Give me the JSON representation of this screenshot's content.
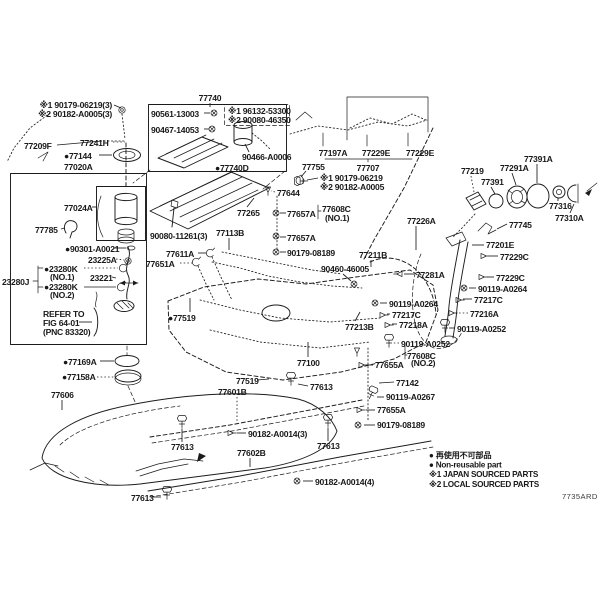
{
  "diagram": {
    "figure_code": "7735ARD",
    "legend": [
      {
        "prefix": "●",
        "text": "再使用不可部品"
      },
      {
        "prefix": "●",
        "text": "Non-reusable part"
      },
      {
        "prefix": "※1",
        "text": "JAPAN SOURCED PARTS"
      },
      {
        "prefix": "※2",
        "text": "LOCAL SOURCED PARTS"
      }
    ],
    "labels": [
      {
        "t": "※1 90179-06219(3)",
        "x": 112,
        "y": 108,
        "a": "e",
        "ln": [
          114,
          105,
          121,
          108
        ]
      },
      {
        "t": "※2 90182-A0005(3)",
        "x": 112,
        "y": 117,
        "a": "e"
      },
      {
        "t": "77209F",
        "x": 24,
        "y": 149,
        "ln": [
          57,
          145,
          102,
          141
        ]
      },
      {
        "t": "77241H",
        "x": 80,
        "y": 146,
        "ln": [
          113,
          142,
          125,
          142
        ],
        "ld": 1
      },
      {
        "t": "77144",
        "x": 64,
        "y": 159,
        "b": 1,
        "ln": [
          99,
          155,
          112,
          155
        ]
      },
      {
        "t": "77020A",
        "x": 64,
        "y": 170
      },
      {
        "t": "77740",
        "x": 210,
        "y": 101,
        "a": "m",
        "ln": [
          210,
          103,
          210,
          107
        ]
      },
      {
        "t": "90561-13003",
        "x": 151,
        "y": 117,
        "ln": [
          204,
          113,
          210,
          113
        ]
      },
      {
        "t": "90467-14053",
        "x": 151,
        "y": 133,
        "ln": [
          204,
          129,
          209,
          129
        ]
      },
      {
        "t": "※1 96132-53300",
        "x": 228,
        "y": 114
      },
      {
        "t": "※2 90080-46350",
        "x": 228,
        "y": 123
      },
      {
        "t": "90466-A0006",
        "x": 242,
        "y": 160,
        "ln": [
          249,
          152,
          245,
          144
        ]
      },
      {
        "t": "77740D",
        "x": 215,
        "y": 171,
        "b": 1
      },
      {
        "t": "77197A",
        "x": 333,
        "y": 156,
        "a": "m"
      },
      {
        "t": "77229E",
        "x": 376,
        "y": 156,
        "a": "m"
      },
      {
        "t": "77229E",
        "x": 420,
        "y": 156,
        "a": "m"
      },
      {
        "t": "77707",
        "x": 368,
        "y": 171,
        "a": "m"
      },
      {
        "t": "77755",
        "x": 302,
        "y": 170,
        "ln": [
          306,
          171,
          301,
          177
        ]
      },
      {
        "t": "※1 90179-06219",
        "x": 320,
        "y": 181,
        "ln": [
          318,
          178,
          307,
          180
        ]
      },
      {
        "t": "※2 90182-A0005",
        "x": 320,
        "y": 190
      },
      {
        "t": "77644",
        "x": 277,
        "y": 196,
        "ln": [
          275,
          192,
          271,
          191
        ],
        "ld": 1
      },
      {
        "t": "77657A",
        "x": 287,
        "y": 217,
        "ln": [
          286,
          213,
          280,
          213
        ]
      },
      {
        "t": "77608C",
        "x": 322,
        "y": 212
      },
      {
        "t": "(NO.1)",
        "x": 325,
        "y": 221
      },
      {
        "t": "77657A",
        "x": 287,
        "y": 241,
        "ln": [
          286,
          237,
          280,
          237
        ]
      },
      {
        "t": "90179-08189",
        "x": 287,
        "y": 256,
        "ln": [
          286,
          252,
          280,
          252
        ]
      },
      {
        "t": "90080-11261(3)",
        "x": 150,
        "y": 239
      },
      {
        "t": "77113B",
        "x": 216,
        "y": 236,
        "ln": [
          229,
          238,
          229,
          250
        ]
      },
      {
        "t": "77611A",
        "x": 166,
        "y": 257,
        "ln": [
          198,
          253,
          206,
          253
        ]
      },
      {
        "t": "77651A",
        "x": 146,
        "y": 267,
        "ln": [
          180,
          263,
          192,
          263
        ],
        "ld": 1
      },
      {
        "t": "77519",
        "x": 168,
        "y": 321,
        "b": 1,
        "ln": [
          190,
          312,
          190,
          298
        ]
      },
      {
        "t": "90460-46005",
        "x": 321,
        "y": 272,
        "ln": [
          343,
          274,
          351,
          281
        ]
      },
      {
        "t": "77211B",
        "x": 359,
        "y": 258,
        "ln": [
          371,
          260,
          371,
          267
        ]
      },
      {
        "t": "77281A",
        "x": 416,
        "y": 278,
        "ln": [
          414,
          274,
          404,
          274
        ]
      },
      {
        "t": "77226A",
        "x": 407,
        "y": 224,
        "ln": [
          416,
          226,
          416,
          250
        ]
      },
      {
        "t": "77201E",
        "x": 486,
        "y": 248,
        "ln": [
          484,
          245,
          472,
          245
        ]
      },
      {
        "t": "77229C",
        "x": 500,
        "y": 260,
        "ln": [
          498,
          256,
          489,
          256
        ]
      },
      {
        "t": "77229C",
        "x": 496,
        "y": 281,
        "ln": [
          494,
          277,
          487,
          277
        ]
      },
      {
        "t": "90119-A0264",
        "x": 478,
        "y": 292,
        "ln": [
          476,
          288,
          469,
          288
        ]
      },
      {
        "t": "77217C",
        "x": 474,
        "y": 303,
        "ln": [
          472,
          299,
          463,
          299
        ]
      },
      {
        "t": "77216A",
        "x": 470,
        "y": 317,
        "ln": [
          468,
          313,
          457,
          313
        ],
        "ld": 1
      },
      {
        "t": "90119-A0252",
        "x": 457,
        "y": 332,
        "ln": [
          455,
          328,
          449,
          328
        ]
      },
      {
        "t": "90119-A0264",
        "x": 389,
        "y": 307,
        "ln": [
          387,
          303,
          380,
          303
        ]
      },
      {
        "t": "77217C",
        "x": 392,
        "y": 318,
        "ln": [
          390,
          314,
          387,
          314
        ]
      },
      {
        "t": "77218A",
        "x": 399,
        "y": 328,
        "ln": [
          397,
          324,
          392,
          324
        ]
      },
      {
        "t": "90119-A0252",
        "x": 401,
        "y": 347,
        "ln": [
          399,
          343,
          393,
          343
        ],
        "ld": 1
      },
      {
        "t": "77213B",
        "x": 345,
        "y": 330,
        "ln": [
          355,
          321,
          360,
          312
        ]
      },
      {
        "t": "77219",
        "x": 461,
        "y": 174,
        "ln": [
          471,
          176,
          474,
          192
        ],
        "ld": 1
      },
      {
        "t": "77391",
        "x": 481,
        "y": 185,
        "ln": [
          491,
          187,
          495,
          194
        ]
      },
      {
        "t": "77291A",
        "x": 500,
        "y": 171,
        "ln": [
          512,
          173,
          516,
          185
        ]
      },
      {
        "t": "77391A",
        "x": 524,
        "y": 162,
        "ln": [
          537,
          164,
          537,
          183
        ]
      },
      {
        "t": "77316",
        "x": 549,
        "y": 209,
        "ln": [
          558,
          201,
          558,
          198
        ]
      },
      {
        "t": "77310A",
        "x": 555,
        "y": 221,
        "ln": [
          570,
          213,
          574,
          204
        ]
      },
      {
        "t": "77745",
        "x": 509,
        "y": 228,
        "ln": [
          507,
          224,
          497,
          229
        ]
      },
      {
        "t": "77265",
        "x": 237,
        "y": 216,
        "ln": [
          247,
          207,
          254,
          198
        ]
      },
      {
        "t": "77024A",
        "x": 64,
        "y": 211,
        "ln": [
          92,
          207,
          97,
          207
        ]
      },
      {
        "t": "77785",
        "x": 35,
        "y": 233,
        "ln": [
          61,
          229,
          65,
          228
        ]
      },
      {
        "t": "90301-A0021",
        "x": 65,
        "y": 252,
        "b": 1,
        "ln": [
          114,
          248,
          126,
          248
        ]
      },
      {
        "t": "23225A",
        "x": 88,
        "y": 263,
        "ln": [
          116,
          259,
          124,
          260
        ],
        "ld": 1
      },
      {
        "t": "23280K",
        "x": 44,
        "y": 272,
        "b": 1,
        "ln": [
          84,
          268,
          118,
          268
        ],
        "ld": 1
      },
      {
        "t": "(NO.1)",
        "x": 50,
        "y": 280
      },
      {
        "t": "23280J",
        "x": 2,
        "y": 285
      },
      {
        "t": "23280K",
        "x": 44,
        "y": 290,
        "b": 1,
        "ln": [
          84,
          287,
          116,
          287
        ]
      },
      {
        "t": "(NO.2)",
        "x": 50,
        "y": 298
      },
      {
        "t": "23221",
        "x": 90,
        "y": 281,
        "ln": [
          112,
          277,
          116,
          278
        ]
      },
      {
        "t": "REFER TO",
        "x": 43,
        "y": 317
      },
      {
        "t": "FIG 64-01",
        "x": 43,
        "y": 326,
        "ln": [
          79,
          322,
          92,
          322
        ]
      },
      {
        "t": "(PNC 83320)",
        "x": 43,
        "y": 335
      },
      {
        "t": "77169A",
        "x": 63,
        "y": 365,
        "b": 1,
        "ln": [
          100,
          361,
          114,
          361
        ]
      },
      {
        "t": "77158A",
        "x": 62,
        "y": 380,
        "b": 1,
        "ln": [
          97,
          377,
          114,
          377
        ],
        "ld": 1
      },
      {
        "t": "77606",
        "x": 51,
        "y": 398,
        "ln": [
          62,
          400,
          62,
          410
        ]
      },
      {
        "t": "77100",
        "x": 297,
        "y": 366,
        "ln": [
          308,
          357,
          308,
          342
        ]
      },
      {
        "t": "77519",
        "x": 236,
        "y": 384,
        "ln": [
          257,
          380,
          269,
          379
        ]
      },
      {
        "t": "77601B",
        "x": 218,
        "y": 395,
        "ln": [
          237,
          397,
          237,
          423
        ],
        "ld": 1
      },
      {
        "t": "77613",
        "x": 310,
        "y": 390,
        "ln": [
          308,
          386,
          298,
          384
        ]
      },
      {
        "t": "90182-A0014(3)",
        "x": 248,
        "y": 437,
        "ln": [
          246,
          433,
          237,
          433
        ]
      },
      {
        "t": "77613",
        "x": 171,
        "y": 450,
        "ln": [
          182,
          442,
          182,
          429
        ]
      },
      {
        "t": "77602B",
        "x": 237,
        "y": 456,
        "ln": [
          250,
          458,
          250,
          467
        ]
      },
      {
        "t": "77613",
        "x": 317,
        "y": 449,
        "ln": [
          328,
          441,
          328,
          428
        ]
      },
      {
        "t": "90182-A0014(4)",
        "x": 315,
        "y": 485,
        "ln": [
          313,
          481,
          303,
          481
        ]
      },
      {
        "t": "77613",
        "x": 131,
        "y": 501,
        "ln": [
          153,
          497,
          161,
          497
        ]
      },
      {
        "t": "77655A",
        "x": 375,
        "y": 368,
        "ln": [
          373,
          365,
          366,
          365
        ]
      },
      {
        "t": "77608C",
        "x": 407,
        "y": 359
      },
      {
        "t": "(NO.2)",
        "x": 411,
        "y": 366
      },
      {
        "t": "77142",
        "x": 396,
        "y": 386,
        "ln": [
          394,
          382,
          379,
          383
        ]
      },
      {
        "t": "90119-A0267",
        "x": 386,
        "y": 400,
        "ln": [
          384,
          397,
          377,
          397
        ]
      },
      {
        "t": "77655A",
        "x": 377,
        "y": 413,
        "ln": [
          375,
          410,
          366,
          410
        ]
      },
      {
        "t": "90179-08189",
        "x": 377,
        "y": 428,
        "ln": [
          375,
          425,
          364,
          425
        ]
      }
    ],
    "hardware": [
      {
        "k": "grommet",
        "x": 122,
        "y": 110
      },
      {
        "k": "screw",
        "x": 214,
        "y": 113
      },
      {
        "k": "screw",
        "x": 212,
        "y": 129
      },
      {
        "k": "clip",
        "x": 268,
        "y": 190
      },
      {
        "k": "screw",
        "x": 276,
        "y": 213
      },
      {
        "k": "screw",
        "x": 276,
        "y": 236
      },
      {
        "k": "screw",
        "x": 276,
        "y": 252
      },
      {
        "k": "bolt",
        "x": 301,
        "y": 181,
        "r": -90
      },
      {
        "k": "clamp",
        "x": 210,
        "y": 253
      },
      {
        "k": "clamp",
        "x": 196,
        "y": 262
      },
      {
        "k": "screw",
        "x": 354,
        "y": 284
      },
      {
        "k": "clip",
        "x": 399,
        "y": 274,
        "r": 90
      },
      {
        "k": "clip",
        "x": 484,
        "y": 256,
        "r": -90
      },
      {
        "k": "clip",
        "x": 482,
        "y": 277,
        "r": -90
      },
      {
        "k": "screw",
        "x": 464,
        "y": 288
      },
      {
        "k": "clip",
        "x": 459,
        "y": 300,
        "r": -90
      },
      {
        "k": "clip",
        "x": 452,
        "y": 313,
        "r": -90
      },
      {
        "k": "bolt",
        "x": 445,
        "y": 326
      },
      {
        "k": "screw",
        "x": 375,
        "y": 303
      },
      {
        "k": "clip",
        "x": 383,
        "y": 315,
        "r": -90
      },
      {
        "k": "clip",
        "x": 388,
        "y": 325,
        "r": -90
      },
      {
        "k": "bolt",
        "x": 389,
        "y": 341
      },
      {
        "k": "clip",
        "x": 357,
        "y": 351
      },
      {
        "k": "clip",
        "x": 362,
        "y": 365,
        "r": -90
      },
      {
        "k": "bolt",
        "x": 372,
        "y": 393,
        "r": 25
      },
      {
        "k": "clip",
        "x": 360,
        "y": 410,
        "r": -90
      },
      {
        "k": "screw",
        "x": 358,
        "y": 425
      },
      {
        "k": "bolt",
        "x": 291,
        "y": 379
      },
      {
        "k": "bolt",
        "x": 182,
        "y": 422
      },
      {
        "k": "bolt",
        "x": 328,
        "y": 421
      },
      {
        "k": "bolt",
        "x": 167,
        "y": 493
      },
      {
        "k": "clip",
        "x": 231,
        "y": 433,
        "r": -90
      },
      {
        "k": "screw",
        "x": 297,
        "y": 481
      },
      {
        "k": "washer",
        "x": 131,
        "y": 248
      },
      {
        "k": "grommet",
        "x": 128,
        "y": 261
      },
      {
        "k": "clamp",
        "x": 123,
        "y": 268
      },
      {
        "k": "clamp",
        "x": 121,
        "y": 287
      }
    ]
  }
}
